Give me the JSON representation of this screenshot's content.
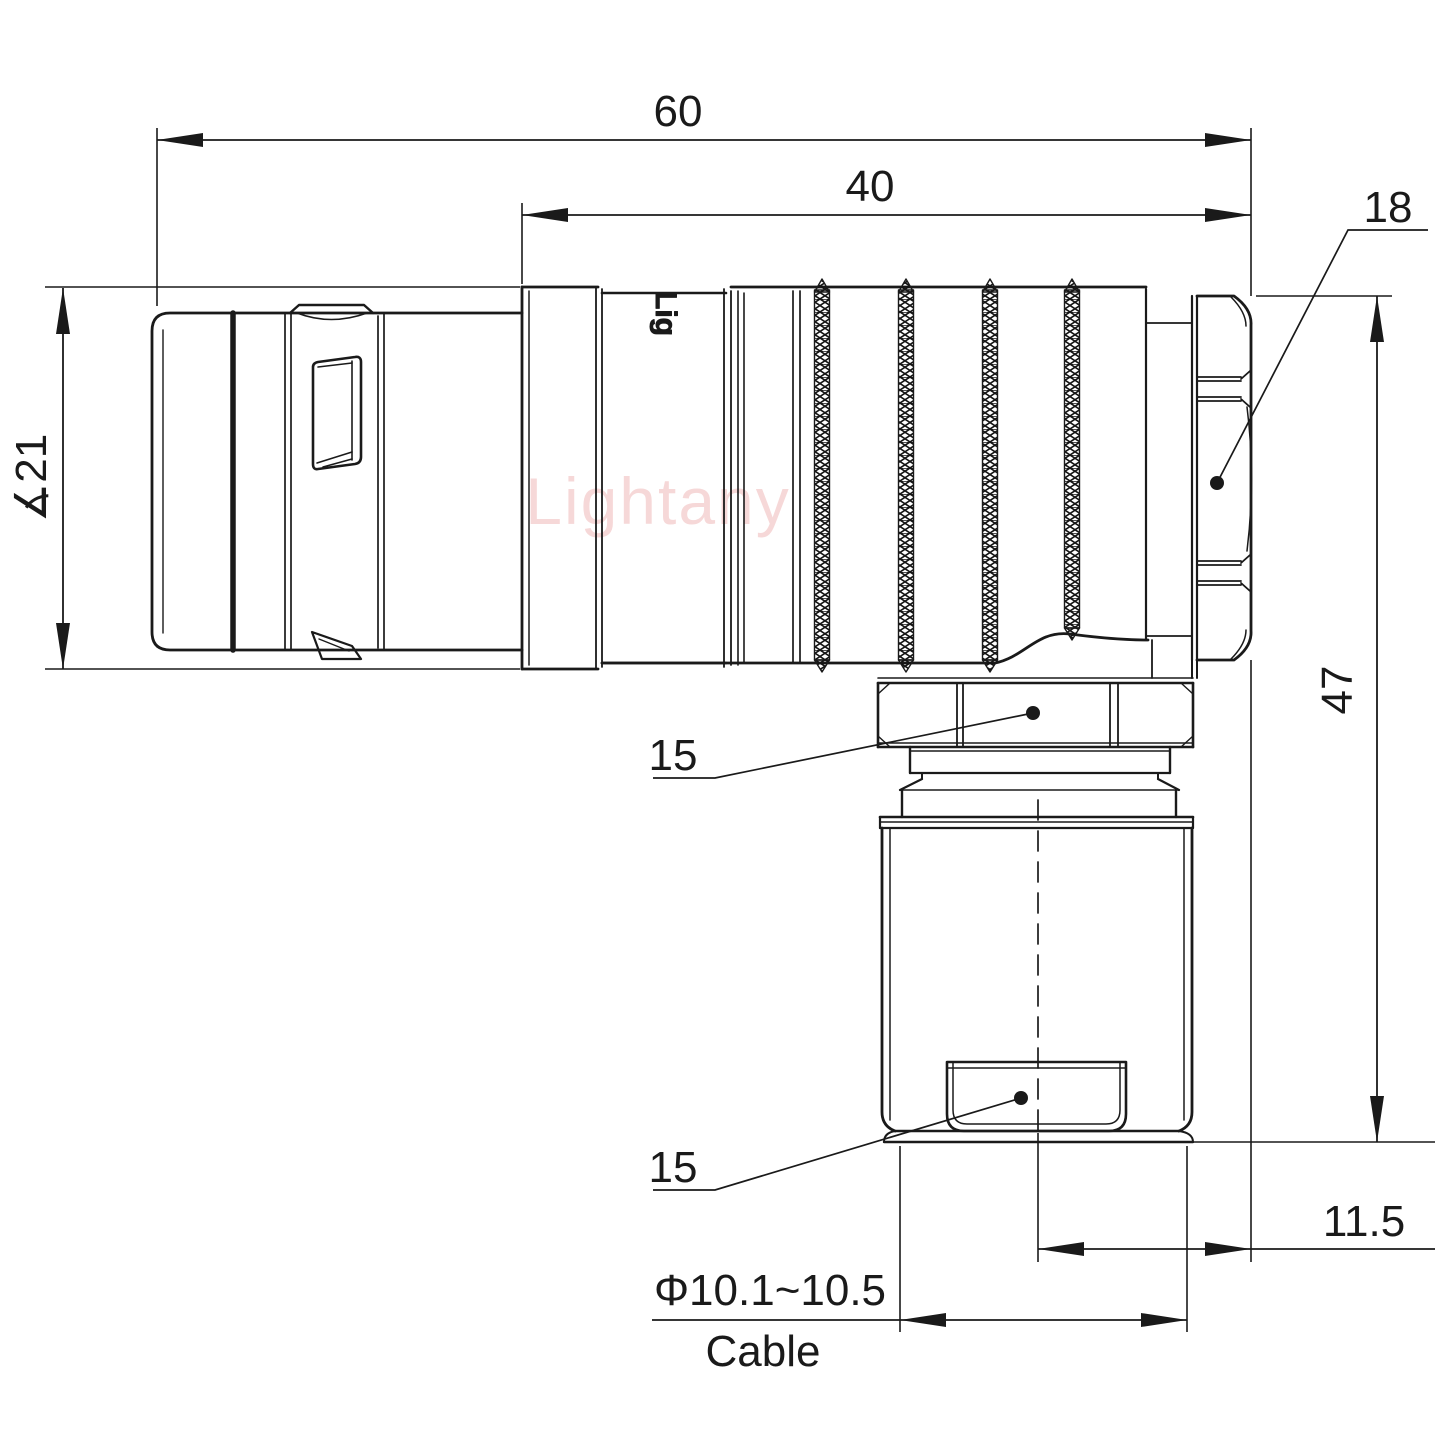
{
  "drawing": {
    "watermark": {
      "text": "Lightany",
      "color": "#f0b9b9"
    },
    "shell_logo": {
      "text": "Lig"
    },
    "colors": {
      "line": "#1a1a1a",
      "background": "#ffffff"
    },
    "dimensions": {
      "overall_length": "60",
      "rear_section_length": "40",
      "coupling_nut_flats": "18",
      "shell_diameter": "∡21",
      "gland_nut_flats_upper": "15",
      "height": "47",
      "clamp_flats_lower": "15",
      "axis_offset": "11.5",
      "cable_diameter_range": "Φ10.1~10.5",
      "cable_label": "Cable"
    }
  }
}
